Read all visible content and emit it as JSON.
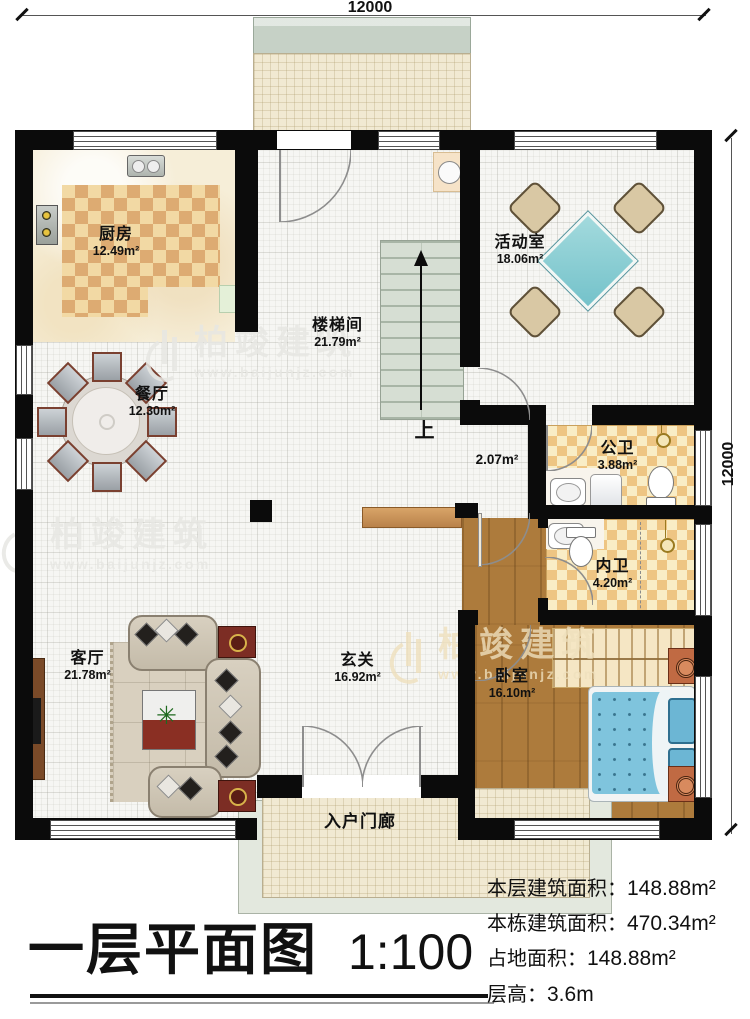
{
  "dimensions": {
    "top": "12000",
    "right": "12000"
  },
  "watermark": {
    "brand": "柏竣建筑",
    "url": "www.baijunjz.com"
  },
  "rooms": {
    "kitchen": {
      "name": "厨房",
      "area": "12.49m²"
    },
    "stairwell": {
      "name": "楼梯间",
      "area": "21.79m²"
    },
    "activity": {
      "name": "活动室",
      "area": "18.06m²"
    },
    "dining": {
      "name": "餐厅",
      "area": "12.30m²"
    },
    "corridor": {
      "area": "2.07m²"
    },
    "public_bath": {
      "name": "公卫",
      "area": "3.88m²"
    },
    "private_bath": {
      "name": "内卫",
      "area": "4.20m²"
    },
    "bedroom": {
      "name": "卧室",
      "area": "16.10m²"
    },
    "living": {
      "name": "客厅",
      "area": "21.78m²"
    },
    "foyer": {
      "name": "玄关",
      "area": "16.92m²"
    },
    "porch": {
      "name": "入户门廊"
    }
  },
  "stairs_up_label": "上",
  "title": {
    "text": "一层平面图",
    "scale": "1:100"
  },
  "stats": [
    {
      "label": "本层建筑面积：",
      "value": "148.88m²"
    },
    {
      "label": "本栋建筑面积：",
      "value": "470.34m²"
    },
    {
      "label": "占地面积：",
      "value": "148.88m²"
    },
    {
      "label": "层高：",
      "value": "3.6m"
    }
  ],
  "colors": {
    "wall": "#0b0b0b",
    "wood_floor": "#ad7b3c",
    "bed": "#7fc4dd",
    "stairs": "#d6ded3",
    "bath_checker": "#eec583",
    "kitchen_rug": "#ddab72",
    "activity_table": "#8ed2d6",
    "porch_floor": "#f1e9d2",
    "accent_red": "#7c2d24"
  }
}
